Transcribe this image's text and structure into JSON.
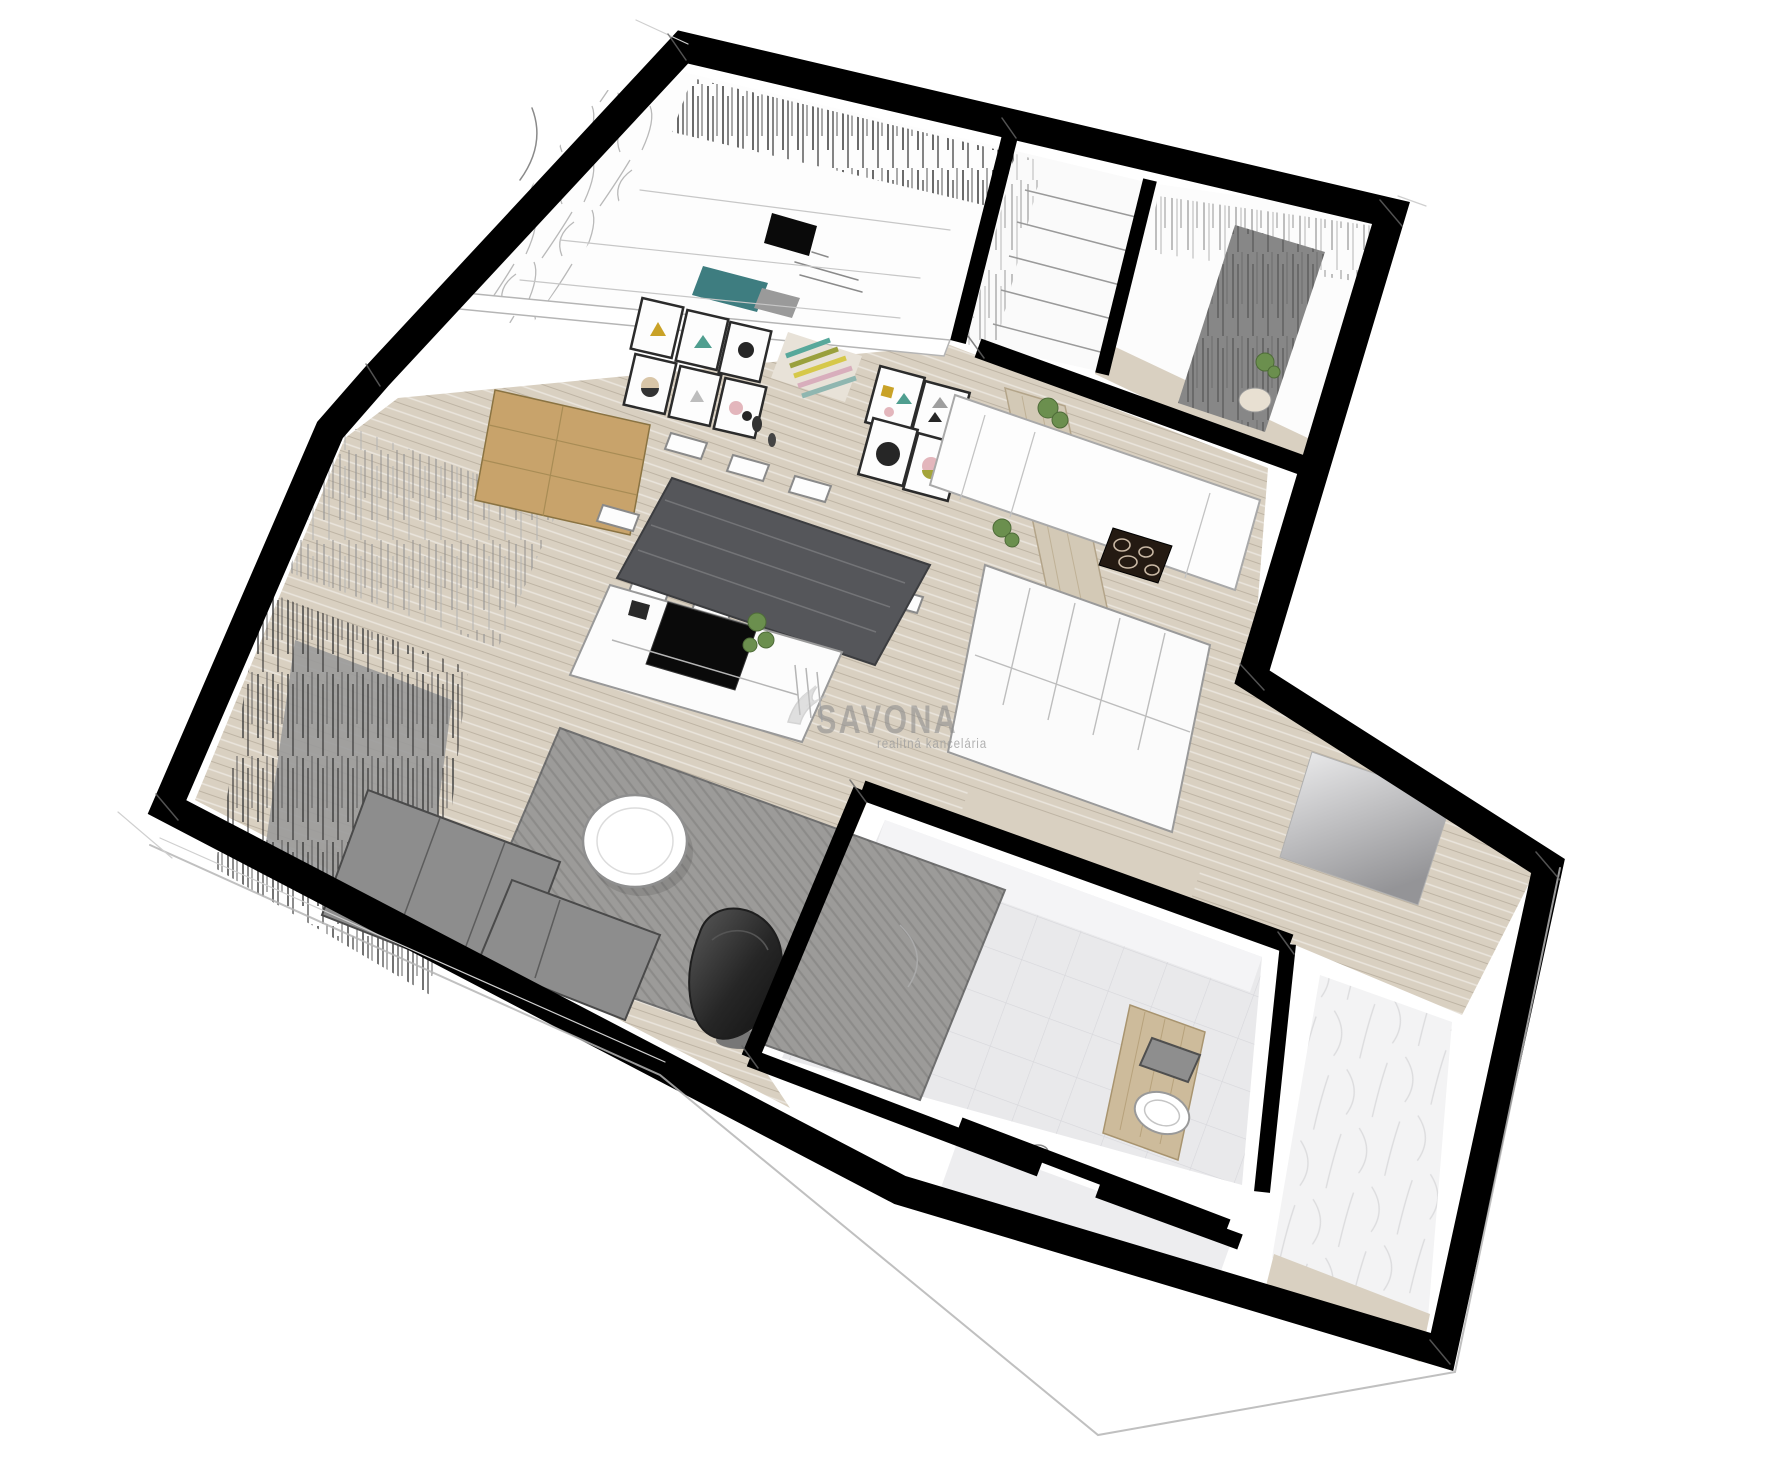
{
  "watermark": {
    "brand": "SAVONA",
    "tagline": "realitná kancelária",
    "logo": "swan-icon",
    "brand_color": "#8f8f8f",
    "tagline_color": "#9f9f9f"
  },
  "palette": {
    "background": "#ffffff",
    "walls": "#000000",
    "wood_floor": "#d9d0c1",
    "wood_accent": "#c8a36b",
    "partition_wood": "#d3c9b6",
    "rug": "#9c9b99",
    "sofa": "#8d8d8d",
    "armchair": "#2f2f2f",
    "wardrobe": "#878787",
    "drape": "#9a9a9a",
    "teal_accent": "#3e7d80",
    "bathroom_tile": "#e9e9eb",
    "storage_wall": "#f3f3f4",
    "hob": "#241a12",
    "tv": "#0a0a0a",
    "plant": "#6b8f4e",
    "dining_table": "#55565a",
    "vanity_wood": "#cdbb9b",
    "entry_mat": "#a8a8a8",
    "art_mustard": "#c9a227",
    "art_teal": "#4f9e8f",
    "art_pink": "#e3b6bc",
    "art_olive": "#a4a43a",
    "art_black": "#262626"
  }
}
